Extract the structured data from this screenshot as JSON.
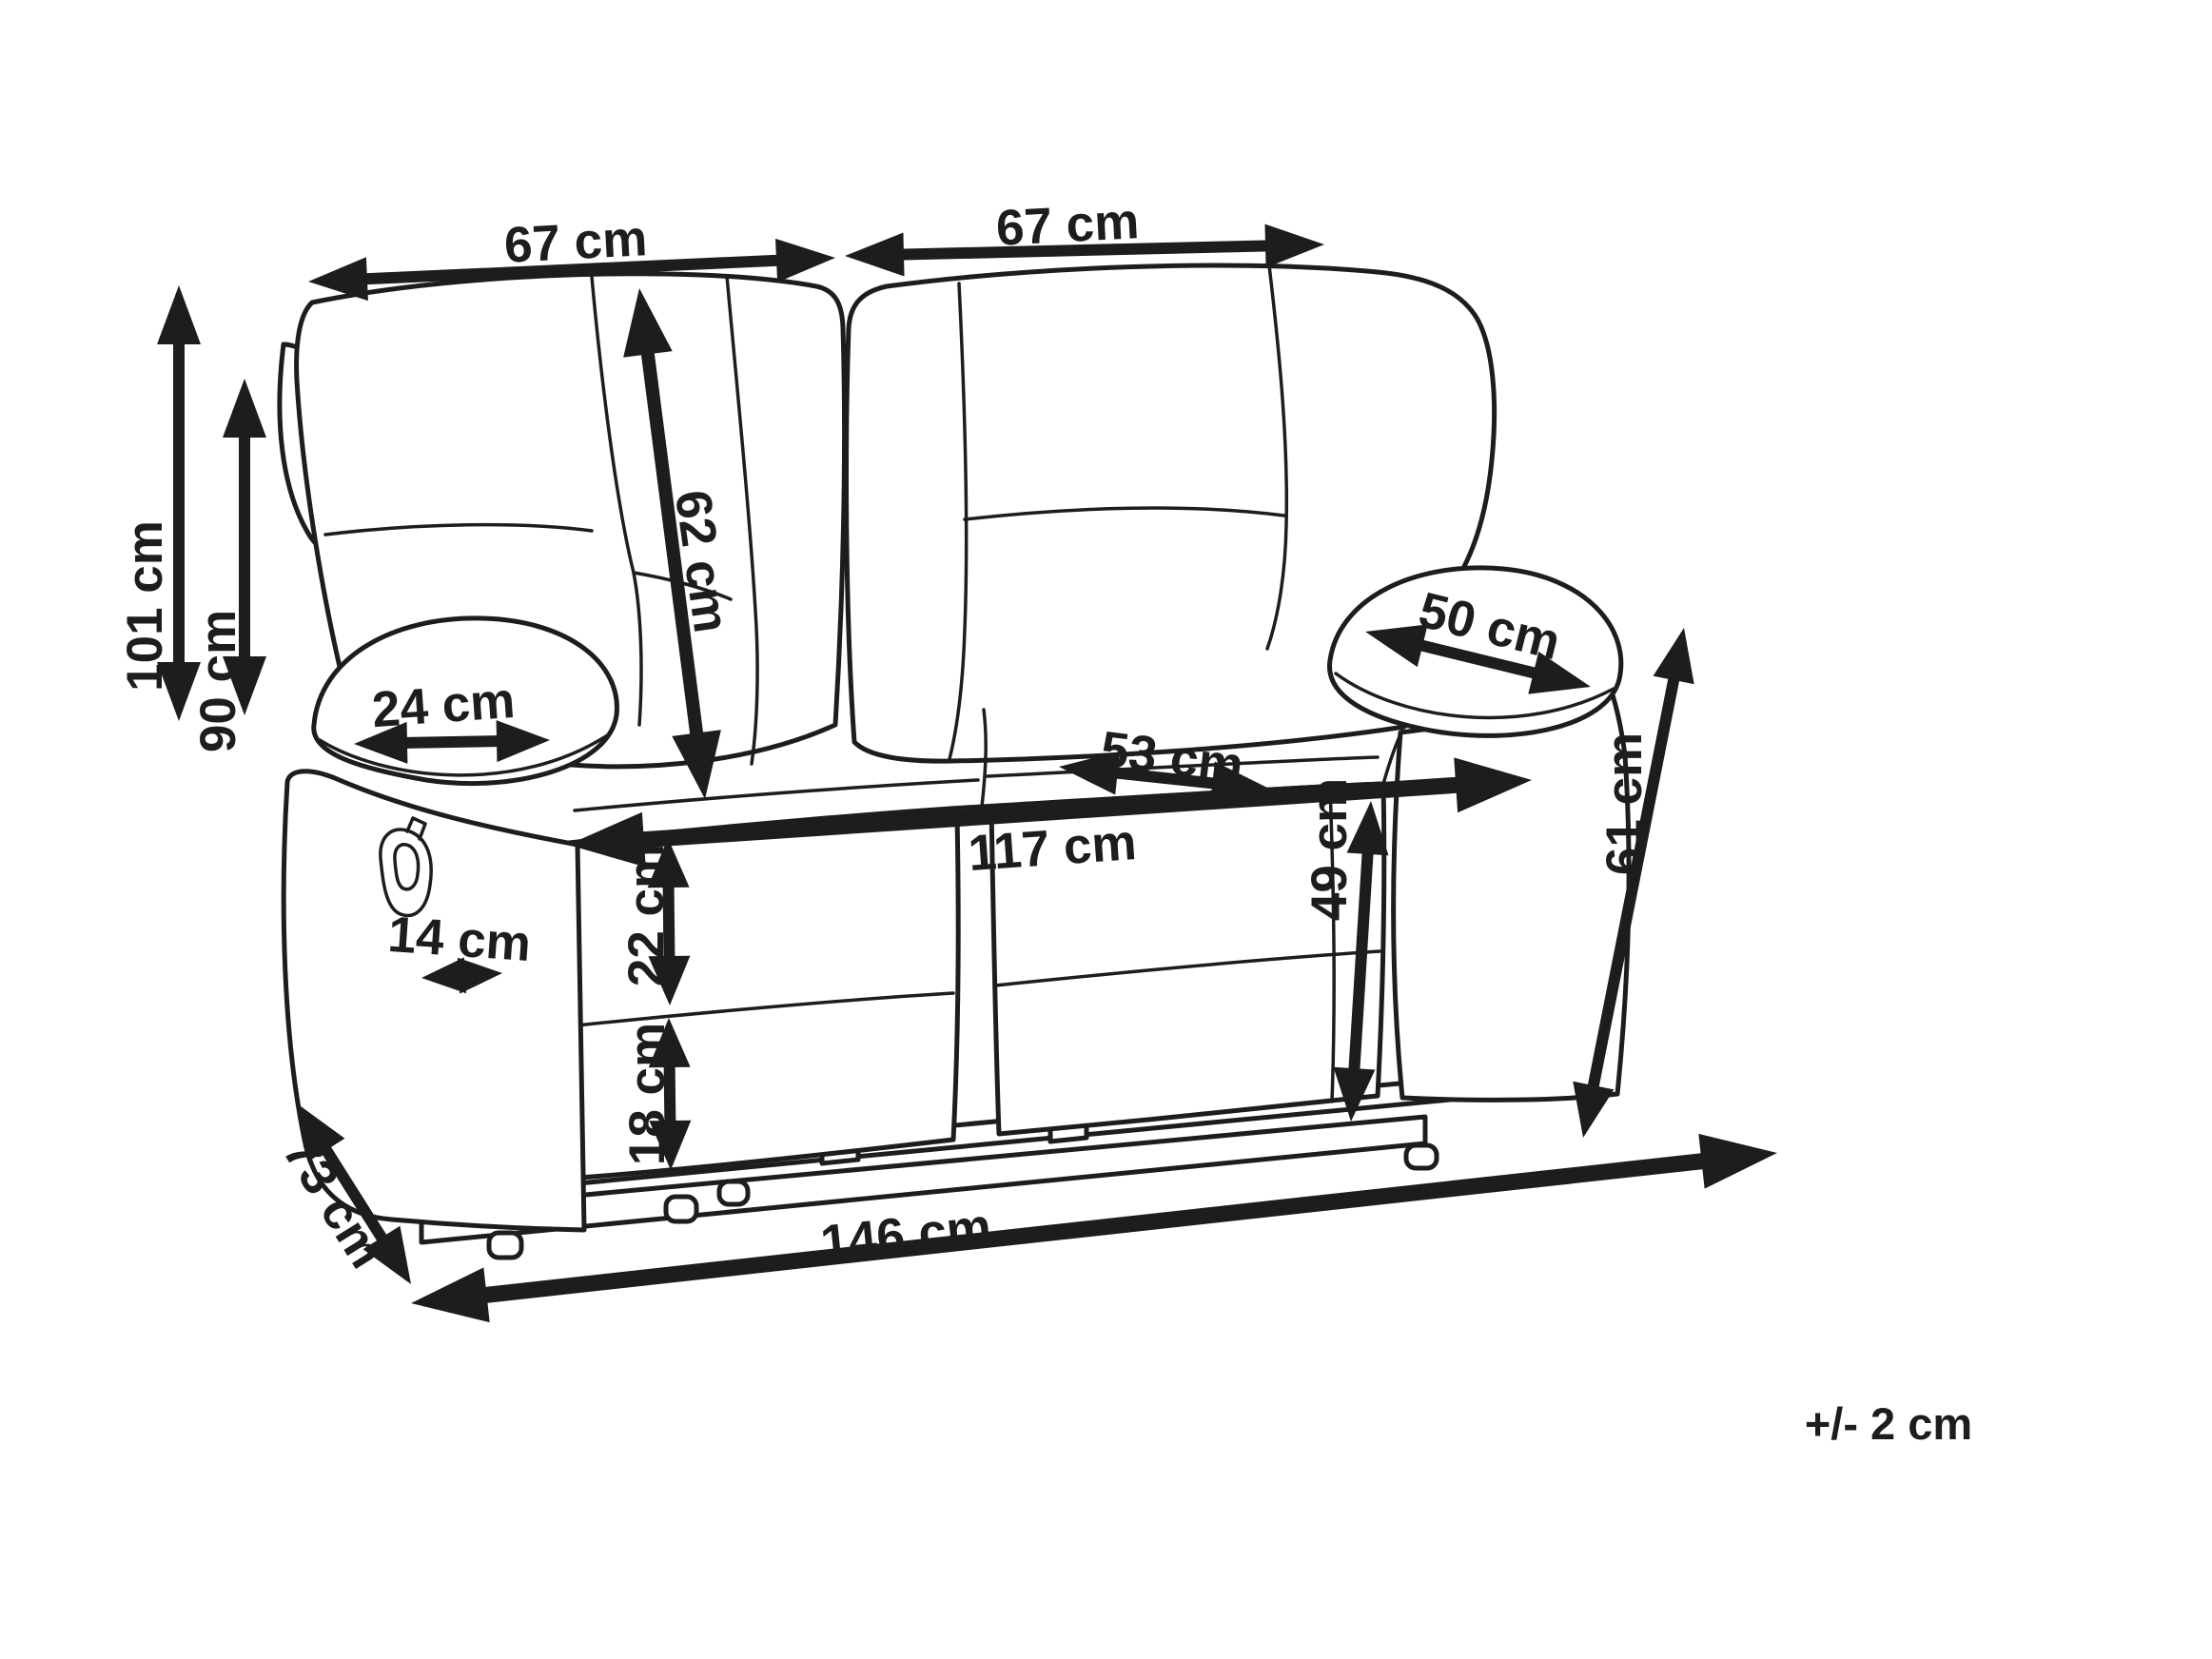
{
  "diagram_type": "furniture dimension drawing",
  "subject": "two-seat recliner sofa line drawing with measurements",
  "unit": "cm",
  "tolerance_note": "+/- 2 cm",
  "colors": {
    "line": "#1d1d1b",
    "background": "#ffffff"
  },
  "dims": {
    "backrest_width_left": {
      "label": "67 cm",
      "value": 67
    },
    "backrest_width_right": {
      "label": "67 cm",
      "value": 67
    },
    "overall_height": {
      "label": "101 cm",
      "value": 101
    },
    "backrest_height": {
      "label": "90 cm",
      "value": 90
    },
    "backrest_diagonal": {
      "label": "62 cm",
      "value": 62
    },
    "armrest_top_width": {
      "label": "24 cm",
      "value": 24
    },
    "armrest_pad_length": {
      "label": "50 cm",
      "value": 50
    },
    "seat_depth": {
      "label": "53 cm",
      "value": 53
    },
    "seat_width": {
      "label": "117 cm",
      "value": 117
    },
    "armrest_front_width": {
      "label": "14 cm",
      "value": 14
    },
    "seat_cushion_height": {
      "label": "22 cm",
      "value": 22
    },
    "base_height": {
      "label": "18 cm",
      "value": 18
    },
    "depth": {
      "label": "73 cm",
      "value": 73
    },
    "overall_width": {
      "label": "146 cm",
      "value": 146
    },
    "seat_height": {
      "label": "49 cm",
      "value": 49
    },
    "armrest_height": {
      "label": "61 cm",
      "value": 61
    }
  }
}
